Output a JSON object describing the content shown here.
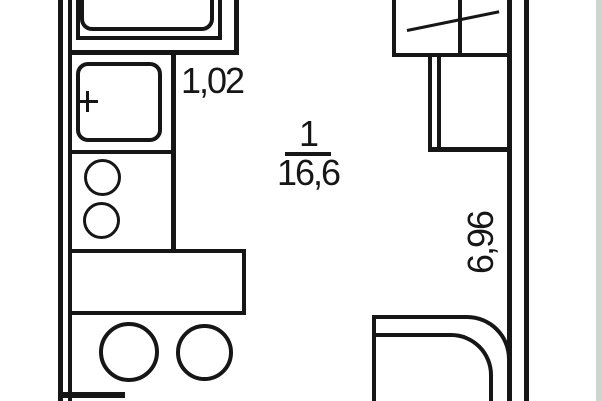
{
  "plan": {
    "labels": {
      "bathroom_area": "1,02",
      "room_number": "1",
      "room_area": "16,6",
      "wall_length": "6,96"
    },
    "colors": {
      "ink": "#161616",
      "background": "#ffffff",
      "page_edge_strip": "#ccd6d1"
    }
  }
}
